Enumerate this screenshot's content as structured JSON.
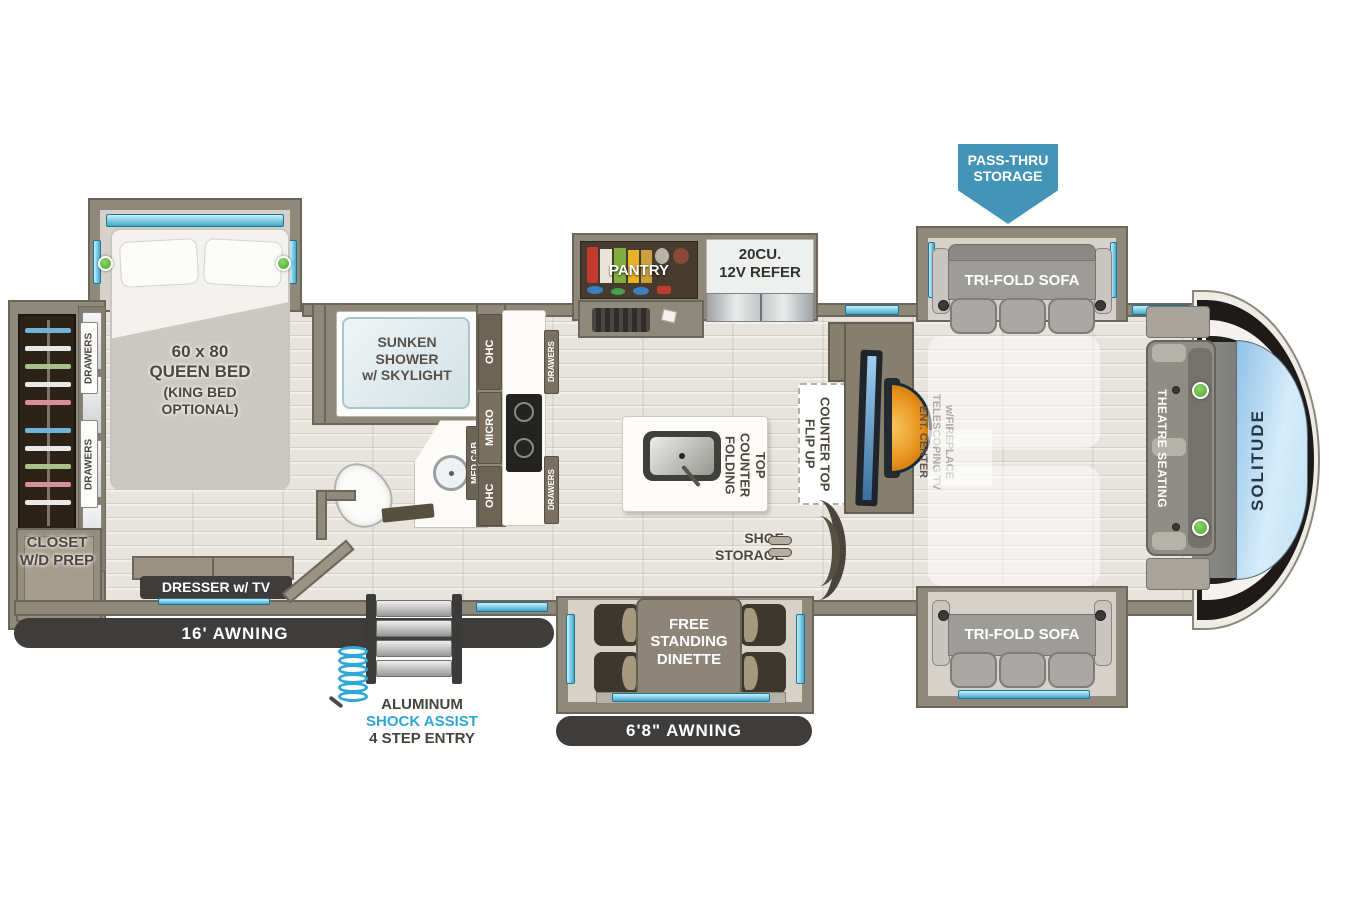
{
  "model": {
    "brand_mark": "SOLITUDE"
  },
  "colors": {
    "storage_arrow_blue": "#4494b8",
    "shock_assist_blue": "#2fa8d5",
    "window_cyan": "#3fa9cc",
    "reading_light_green": "#4ea332",
    "awning_bar_dark": "#3e3d3b",
    "wall_taupe": "#8f897c",
    "fireplace_orange": "#e8941c",
    "cap_blue": "#bfe2f6"
  },
  "callouts": {
    "pass_thru_storage": "PASS-THRU\nSTORAGE",
    "tri_fold_sofa": "TRI-FOLD SOFA",
    "theatre_seating": "THEATRE SEATING",
    "queen_bed_size": "60 x 80\nQUEEN BED",
    "queen_bed_option": "(KING BED\nOPTIONAL)",
    "drawers": "DRAWERS",
    "closet": "CLOSET\nW/D PREP",
    "dresser_tv": "DRESSER w/ TV",
    "awning_rear": "16'  AWNING",
    "awning_entry": "6'8\"  AWNING",
    "sunken_shower": "SUNKEN\nSHOWER\nw/ SKYLIGHT",
    "ohc": "OHC",
    "micro": "MICRO",
    "med_cab": "MED CAB",
    "pantry": "PANTRY",
    "refrigerator": "20CU.\n12V REFER",
    "folding_counter_top": "FOLDING\nCOUNTER TOP",
    "flip_up_counter_top": "FLIP UP\nCOUNTER TOP",
    "entertainment_center": "ENT. CENTER\nTELESCOPING TV\nw/FIREPLACE",
    "shoe_storage": "SHOE\nSTORAGE",
    "dinette": "FREE\nSTANDING\nDINETTE",
    "entry_material": "ALUMINUM",
    "entry_feature": "SHOCK ASSIST",
    "entry_steps": "4 STEP ENTRY"
  }
}
